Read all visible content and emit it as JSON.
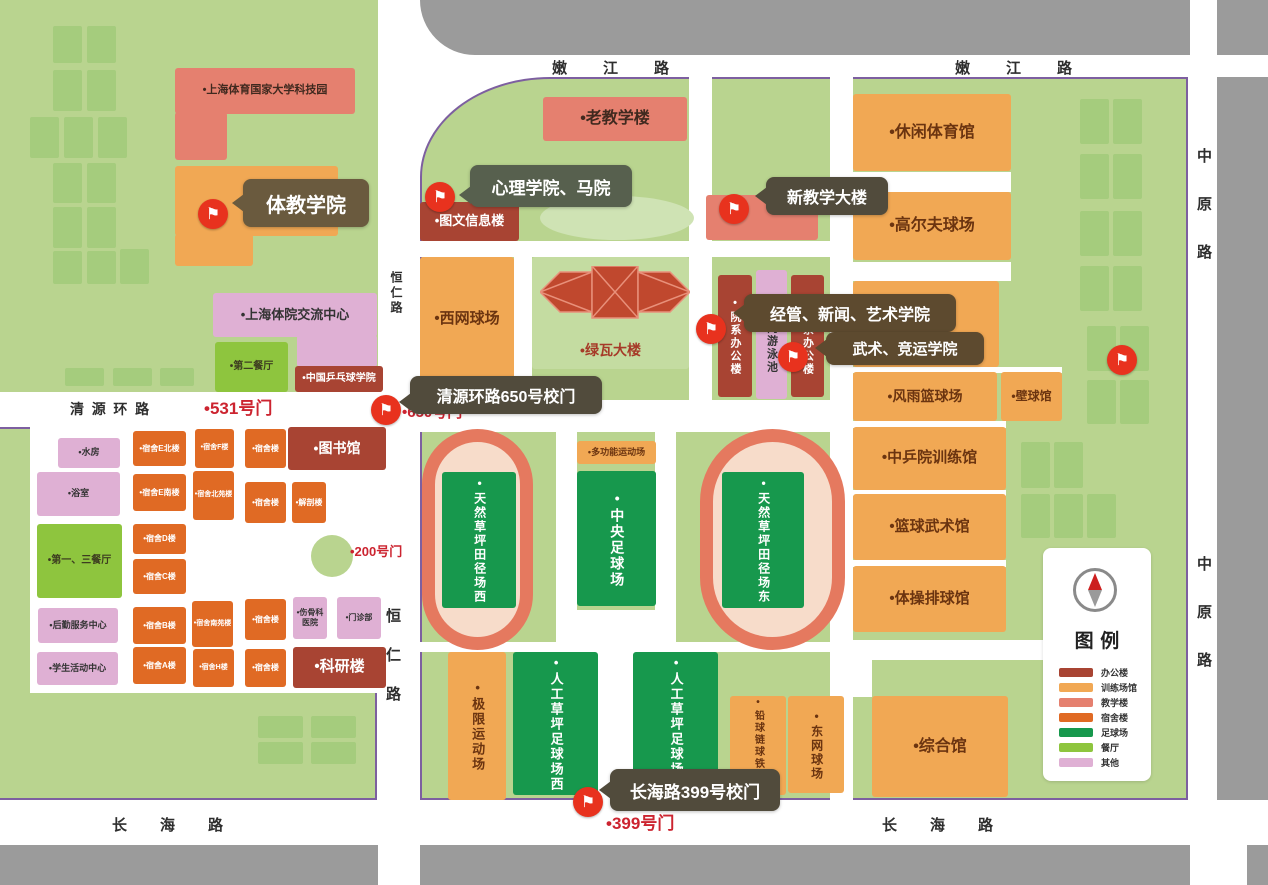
{
  "palette": {
    "bg_green": "#b9d48f",
    "tree": "#a5cc7d",
    "road_gray": "#9b9b9b",
    "boundary": "#7d5fa0",
    "track_ring": "#e5795f",
    "track_infield": "#f7dcca",
    "flag_red": "#e8321e",
    "gate_text": "#cc2430",
    "fill": {
      "office": "#a84433",
      "training": "#f1a854",
      "teaching": "#e5806f",
      "dorm": "#e06a24",
      "football": "#17984d",
      "dining": "#8ec53e",
      "other": "#dfb0d4",
      "block": "#c4dca1",
      "block2": "#cfe3b4"
    },
    "text": {
      "office": "#ffffff",
      "training": "#6b3410",
      "teaching": "#40291f",
      "dorm": "#ffffff",
      "football": "#ffffff",
      "dining": "#3d3d20",
      "other": "#4a4a4a",
      "block": "#a63a28",
      "block2": "#a63a28"
    }
  },
  "roads": {
    "labels": [
      {
        "name": "road-label-nenjiang-west",
        "text": "嫩江路",
        "x": 552,
        "y": 57,
        "fs": 15,
        "ls": "2.4em"
      },
      {
        "name": "road-label-nenjiang-east",
        "text": "嫩江路",
        "x": 955,
        "y": 57,
        "fs": 15,
        "ls": "2.4em"
      },
      {
        "name": "road-label-zhongyuan-top",
        "text": "中原路",
        "x": 1193,
        "y": 148,
        "fs": 15,
        "ls": "2.2em",
        "v": true
      },
      {
        "name": "road-label-zhongyuan-bottom",
        "text": "中原路",
        "x": 1193,
        "y": 556,
        "fs": 15,
        "ls": "2.2em",
        "v": true
      },
      {
        "name": "road-label-hengren-top",
        "text": "恒仁路",
        "x": 388,
        "y": 271,
        "fs": 12,
        "ls": "0.25em",
        "v": true
      },
      {
        "name": "road-label-hengren-bottom",
        "text": "恒仁路",
        "x": 382,
        "y": 608,
        "fs": 15,
        "ls": "1.6em",
        "v": true
      },
      {
        "name": "road-label-qingyuan",
        "text": "清源环路",
        "x": 70,
        "y": 399,
        "fs": 14,
        "ls": "0.55em"
      },
      {
        "name": "road-label-changhai-west",
        "text": "长海路",
        "x": 112,
        "y": 814,
        "fs": 15,
        "ls": "2.2em"
      },
      {
        "name": "road-label-changhai-east",
        "text": "长海路",
        "x": 882,
        "y": 814,
        "fs": 15,
        "ls": "2.2em"
      }
    ]
  },
  "gates": [
    {
      "name": "gate-label-531",
      "label": "•531号门",
      "x": 204,
      "y": 394,
      "fs": 17
    },
    {
      "name": "gate-label-650",
      "label": "•650号门",
      "x": 402,
      "y": 401,
      "fs": 15
    },
    {
      "name": "gate-label-200",
      "label": "•200号门",
      "x": 350,
      "y": 541,
      "fs": 13
    },
    {
      "name": "gate-label-399",
      "label": "•399号门",
      "x": 606,
      "y": 809,
      "fs": 17
    }
  ],
  "tooltips": [
    {
      "name": "tooltip-tijiao-xueyuan",
      "text": "体教学院",
      "x": 243,
      "y": 179,
      "w": 126,
      "h": 48,
      "fs": 20,
      "color": "#6a5a3e",
      "ptr": 24
    },
    {
      "name": "tooltip-xinli-xueyuan",
      "text": "心理学院、马院",
      "x": 470,
      "y": 165,
      "w": 162,
      "h": 42,
      "fs": 17,
      "color": "#57604e",
      "ptr": 30
    },
    {
      "name": "tooltip-xin-jiaoxue-dalou",
      "text": "新教学大楼",
      "x": 766,
      "y": 177,
      "w": 122,
      "h": 38,
      "fs": 16,
      "color": "#514b3c",
      "ptr": 19
    },
    {
      "name": "tooltip-qingyuan-gate",
      "text": "清源环路650号校门",
      "x": 410,
      "y": 376,
      "w": 192,
      "h": 38,
      "fs": 16,
      "color": "#514b3c",
      "ptr": 26
    },
    {
      "name": "tooltip-jingguan-xinwen",
      "text": "经管、新闻、艺术学院",
      "x": 744,
      "y": 294,
      "w": 212,
      "h": 38,
      "fs": 16,
      "color": "#5d4a2f",
      "ptr": 19
    },
    {
      "name": "tooltip-wushu-jingyun",
      "text": "武术、竞运学院",
      "x": 826,
      "y": 332,
      "w": 158,
      "h": 33,
      "fs": 15,
      "color": "#5d4a2f",
      "ptr": 16
    },
    {
      "name": "tooltip-changhai-gate",
      "text": "长海路399号校门",
      "x": 610,
      "y": 769,
      "w": 170,
      "h": 42,
      "fs": 17,
      "color": "#514b3c",
      "ptr": 21
    }
  ],
  "flags": [
    {
      "name": "flag-marker-tijiao",
      "x": 213,
      "y": 214
    },
    {
      "name": "flag-marker-tuwen",
      "x": 440,
      "y": 197
    },
    {
      "name": "flag-marker-xinjiaoxue",
      "x": 734,
      "y": 209
    },
    {
      "name": "flag-marker-yuanxi-a",
      "x": 711,
      "y": 329
    },
    {
      "name": "flag-marker-yuanxi-b",
      "x": 793,
      "y": 357
    },
    {
      "name": "flag-marker-gate-650",
      "x": 386,
      "y": 410
    },
    {
      "name": "flag-marker-east",
      "x": 1122,
      "y": 360
    },
    {
      "name": "flag-marker-gate-399",
      "x": 588,
      "y": 802
    }
  ],
  "buildings": [
    {
      "name": "science-park",
      "label": "•上海体育国家大学科技园",
      "x": 175,
      "y": 68,
      "w": 180,
      "h": 46,
      "t": "teaching",
      "fs": 11
    },
    {
      "name": "science-park-wing",
      "label": "",
      "x": 175,
      "y": 112,
      "w": 52,
      "h": 48,
      "t": "teaching"
    },
    {
      "name": "tijiao-college",
      "label": "",
      "x": 175,
      "y": 166,
      "w": 163,
      "h": 70,
      "t": "training"
    },
    {
      "name": "tijiao-college-wing",
      "label": "",
      "x": 175,
      "y": 234,
      "w": 78,
      "h": 32,
      "t": "training"
    },
    {
      "name": "exchange-center",
      "label": "•上海体院交流中心",
      "x": 213,
      "y": 293,
      "w": 164,
      "h": 44,
      "t": "other",
      "fs": 13,
      "tc": "#333333"
    },
    {
      "name": "exchange-center-wing",
      "label": "",
      "x": 297,
      "y": 335,
      "w": 80,
      "h": 32,
      "t": "other"
    },
    {
      "name": "no2-dining-hall",
      "label": "•第二餐厅",
      "x": 215,
      "y": 342,
      "w": 73,
      "h": 50,
      "t": "dining",
      "fs": 10
    },
    {
      "name": "table-tennis-college",
      "label": "•中国乒乓球学院",
      "x": 295,
      "y": 366,
      "w": 88,
      "h": 26,
      "t": "office",
      "fs": 10
    },
    {
      "name": "water-room",
      "label": "•水房",
      "x": 58,
      "y": 438,
      "w": 62,
      "h": 30,
      "t": "other",
      "fs": 9,
      "tc": "#333333"
    },
    {
      "name": "bath-room",
      "label": "•浴室",
      "x": 37,
      "y": 472,
      "w": 83,
      "h": 44,
      "t": "other",
      "fs": 9,
      "tc": "#333333"
    },
    {
      "name": "no13-dining-hall",
      "label": "•第一、三餐厅",
      "x": 37,
      "y": 524,
      "w": 85,
      "h": 74,
      "t": "dining",
      "fs": 10
    },
    {
      "name": "logistics-center",
      "label": "•后勤服务中心",
      "x": 38,
      "y": 608,
      "w": 80,
      "h": 35,
      "t": "other",
      "fs": 9,
      "tc": "#333333"
    },
    {
      "name": "student-center",
      "label": "•学生活动中心",
      "x": 37,
      "y": 652,
      "w": 81,
      "h": 33,
      "t": "other",
      "fs": 9,
      "tc": "#333333"
    },
    {
      "name": "dorm-e-north",
      "label": "•宿舍E北楼",
      "x": 133,
      "y": 431,
      "w": 53,
      "h": 35,
      "t": "dorm",
      "fs": 8
    },
    {
      "name": "dorm-e-south",
      "label": "•宿舍E南楼",
      "x": 133,
      "y": 474,
      "w": 53,
      "h": 37,
      "t": "dorm",
      "fs": 8
    },
    {
      "name": "dorm-d",
      "label": "•宿舍D楼",
      "x": 133,
      "y": 524,
      "w": 53,
      "h": 30,
      "t": "dorm",
      "fs": 8
    },
    {
      "name": "dorm-c",
      "label": "•宿舍C楼",
      "x": 133,
      "y": 559,
      "w": 53,
      "h": 35,
      "t": "dorm",
      "fs": 8
    },
    {
      "name": "dorm-b",
      "label": "•宿舍B楼",
      "x": 133,
      "y": 607,
      "w": 53,
      "h": 37,
      "t": "dorm",
      "fs": 8
    },
    {
      "name": "dorm-a",
      "label": "•宿舍A楼",
      "x": 133,
      "y": 647,
      "w": 53,
      "h": 37,
      "t": "dorm",
      "fs": 8
    },
    {
      "name": "dorm-f",
      "label": "•宿舍F楼",
      "x": 195,
      "y": 429,
      "w": 39,
      "h": 39,
      "t": "dorm",
      "fs": 7
    },
    {
      "name": "dorm-beiyuan",
      "label": "•宿舍北苑楼",
      "x": 193,
      "y": 471,
      "w": 41,
      "h": 49,
      "t": "dorm",
      "fs": 7
    },
    {
      "name": "dorm-nanyuan",
      "label": "•宿舍南苑楼",
      "x": 192,
      "y": 601,
      "w": 41,
      "h": 46,
      "t": "dorm",
      "fs": 7
    },
    {
      "name": "dorm-h",
      "label": "•宿舍H楼",
      "x": 193,
      "y": 649,
      "w": 41,
      "h": 38,
      "t": "dorm",
      "fs": 7
    },
    {
      "name": "dorm-1",
      "label": "•宿舍楼",
      "x": 245,
      "y": 429,
      "w": 41,
      "h": 39,
      "t": "dorm",
      "fs": 8
    },
    {
      "name": "dorm-2",
      "label": "•宿舍楼",
      "x": 245,
      "y": 482,
      "w": 41,
      "h": 41,
      "t": "dorm",
      "fs": 8
    },
    {
      "name": "dorm-3",
      "label": "•宿舍楼",
      "x": 245,
      "y": 599,
      "w": 41,
      "h": 41,
      "t": "dorm",
      "fs": 8
    },
    {
      "name": "dorm-4",
      "label": "•宿舍楼",
      "x": 245,
      "y": 649,
      "w": 41,
      "h": 38,
      "t": "dorm",
      "fs": 8
    },
    {
      "name": "anatomy-building",
      "label": "•解剖楼",
      "x": 292,
      "y": 482,
      "w": 34,
      "h": 41,
      "t": "dorm",
      "fs": 8
    },
    {
      "name": "library",
      "label": "•图书馆",
      "x": 288,
      "y": 427,
      "w": 98,
      "h": 43,
      "t": "office",
      "fs": 14
    },
    {
      "name": "osteopathy-hospital",
      "label": "•伤骨科医院",
      "x": 293,
      "y": 597,
      "w": 34,
      "h": 42,
      "t": "other",
      "fs": 8,
      "tc": "#333333"
    },
    {
      "name": "clinic",
      "label": "•门诊部",
      "x": 337,
      "y": 597,
      "w": 44,
      "h": 42,
      "t": "other",
      "fs": 8,
      "tc": "#333333"
    },
    {
      "name": "research-building",
      "label": "•科研楼",
      "x": 293,
      "y": 647,
      "w": 93,
      "h": 41,
      "t": "office",
      "fs": 15
    },
    {
      "name": "old-teaching-building",
      "label": "•老教学楼",
      "x": 543,
      "y": 97,
      "w": 144,
      "h": 44,
      "t": "teaching",
      "fs": 16
    },
    {
      "name": "library-info-building",
      "label": "•图文信息楼",
      "x": 420,
      "y": 202,
      "w": 99,
      "h": 39,
      "t": "office",
      "fs": 13
    },
    {
      "name": "new-teaching-building",
      "label": "",
      "x": 706,
      "y": 195,
      "w": 112,
      "h": 45,
      "t": "teaching"
    },
    {
      "name": "west-tennis-court",
      "label": "•西网球场",
      "x": 420,
      "y": 257,
      "w": 94,
      "h": 124,
      "t": "training",
      "fs": 15
    },
    {
      "name": "lvwa-building",
      "label": "•绿瓦大楼",
      "x": 532,
      "y": 257,
      "w": 157,
      "h": 112,
      "t": "block",
      "fs": 14,
      "la": "bottom"
    },
    {
      "name": "grass-oval",
      "label": "",
      "x": 540,
      "y": 196,
      "w": 154,
      "h": 44,
      "t": "block2",
      "round": true
    },
    {
      "name": "dept-office-a",
      "label": "•院系办公楼",
      "x": 718,
      "y": 275,
      "w": 34,
      "h": 122,
      "t": "office",
      "fs": 11,
      "v": true
    },
    {
      "name": "indoor-pool",
      "label": "•室内游泳池",
      "x": 756,
      "y": 270,
      "w": 31,
      "h": 129,
      "t": "other",
      "fs": 11,
      "v": true,
      "tc": "#333333"
    },
    {
      "name": "dept-office-b",
      "label": "•院系办公楼",
      "x": 791,
      "y": 275,
      "w": 33,
      "h": 122,
      "t": "office",
      "fs": 11,
      "v": true
    },
    {
      "name": "track-field-hall",
      "label": "•田径馆",
      "x": 853,
      "y": 281,
      "w": 146,
      "h": 86,
      "t": "training",
      "fs": 15
    },
    {
      "name": "leisure-sports-gym",
      "label": "•休闲体育馆",
      "x": 853,
      "y": 94,
      "w": 158,
      "h": 77,
      "t": "training",
      "fs": 16
    },
    {
      "name": "golf-course",
      "label": "•高尔夫球场",
      "x": 853,
      "y": 192,
      "w": 158,
      "h": 68,
      "t": "training",
      "fs": 16
    },
    {
      "name": "storm-basketball-court",
      "label": "•风雨篮球场",
      "x": 853,
      "y": 372,
      "w": 144,
      "h": 49,
      "t": "training",
      "fs": 14
    },
    {
      "name": "squash-hall",
      "label": "•壁球馆",
      "x": 1001,
      "y": 372,
      "w": 61,
      "h": 49,
      "t": "training",
      "fs": 12
    },
    {
      "name": "ctt-training-hall",
      "label": "•中乒院训练馆",
      "x": 853,
      "y": 427,
      "w": 153,
      "h": 63,
      "t": "training",
      "fs": 15
    },
    {
      "name": "basketball-wushu-hall",
      "label": "•篮球武术馆",
      "x": 853,
      "y": 494,
      "w": 153,
      "h": 66,
      "t": "training",
      "fs": 15
    },
    {
      "name": "gymnastics-volleyball-hall",
      "label": "•体操排球馆",
      "x": 853,
      "y": 566,
      "w": 153,
      "h": 66,
      "t": "training",
      "fs": 15
    },
    {
      "name": "comprehensive-hall",
      "label": "•综合馆",
      "x": 872,
      "y": 696,
      "w": 136,
      "h": 101,
      "t": "training",
      "fs": 16
    },
    {
      "name": "multifunction-field",
      "label": "•多功能运动场",
      "x": 577,
      "y": 441,
      "w": 79,
      "h": 23,
      "t": "training",
      "fs": 9
    },
    {
      "name": "natural-turf-west",
      "label": "•天然草坪田径场西",
      "x": 442,
      "y": 472,
      "w": 74,
      "h": 136,
      "t": "football",
      "fs": 12,
      "v": true
    },
    {
      "name": "central-football-field",
      "label": "•中央足球场",
      "x": 577,
      "y": 471,
      "w": 79,
      "h": 135,
      "t": "football",
      "fs": 14,
      "v": true
    },
    {
      "name": "natural-turf-east",
      "label": "•天然草坪田径场东",
      "x": 722,
      "y": 472,
      "w": 82,
      "h": 136,
      "t": "football",
      "fs": 12,
      "v": true
    },
    {
      "name": "extreme-sports-field",
      "label": "•极限运动场",
      "x": 448,
      "y": 652,
      "w": 58,
      "h": 148,
      "t": "training",
      "fs": 13,
      "v": true
    },
    {
      "name": "artificial-turf-west",
      "label": "•人工草坪足球场西",
      "x": 513,
      "y": 652,
      "w": 85,
      "h": 143,
      "t": "football",
      "fs": 13,
      "v": true
    },
    {
      "name": "artificial-turf-east",
      "label": "•人工草坪足球场东",
      "x": 633,
      "y": 652,
      "w": 85,
      "h": 143,
      "t": "football",
      "fs": 13,
      "v": true
    },
    {
      "name": "shot-put-field",
      "label": "•铅球链球铁饼场",
      "x": 730,
      "y": 696,
      "w": 56,
      "h": 99,
      "t": "training",
      "fs": 10,
      "v": true
    },
    {
      "name": "east-tennis-court",
      "label": "•东网球场",
      "x": 788,
      "y": 696,
      "w": 56,
      "h": 97,
      "t": "training",
      "fs": 12,
      "v": true
    }
  ],
  "trees": [
    [
      53,
      26,
      29,
      37
    ],
    [
      87,
      26,
      29,
      37
    ],
    [
      53,
      70,
      29,
      41
    ],
    [
      87,
      70,
      29,
      41
    ],
    [
      30,
      117,
      29,
      41
    ],
    [
      64,
      117,
      29,
      41
    ],
    [
      98,
      117,
      29,
      41
    ],
    [
      53,
      163,
      29,
      40
    ],
    [
      87,
      163,
      29,
      40
    ],
    [
      53,
      207,
      29,
      41
    ],
    [
      87,
      207,
      29,
      41
    ],
    [
      53,
      251,
      29,
      33
    ],
    [
      87,
      251,
      29,
      33
    ],
    [
      120,
      249,
      29,
      35
    ],
    [
      65,
      368,
      39,
      18
    ],
    [
      113,
      368,
      39,
      18
    ],
    [
      160,
      368,
      34,
      18
    ],
    [
      258,
      716,
      45,
      22
    ],
    [
      311,
      716,
      45,
      22
    ],
    [
      258,
      742,
      45,
      22
    ],
    [
      311,
      742,
      45,
      22
    ],
    [
      1080,
      99,
      29,
      45
    ],
    [
      1113,
      99,
      29,
      45
    ],
    [
      1080,
      154,
      29,
      45
    ],
    [
      1113,
      154,
      29,
      45
    ],
    [
      1080,
      211,
      29,
      45
    ],
    [
      1113,
      211,
      29,
      45
    ],
    [
      1080,
      266,
      29,
      45
    ],
    [
      1113,
      266,
      29,
      45
    ],
    [
      1087,
      326,
      29,
      45
    ],
    [
      1120,
      326,
      29,
      45
    ],
    [
      1087,
      380,
      29,
      44
    ],
    [
      1120,
      380,
      29,
      44
    ],
    [
      1021,
      442,
      29,
      46
    ],
    [
      1054,
      442,
      29,
      46
    ],
    [
      1021,
      494,
      29,
      44
    ],
    [
      1054,
      494,
      29,
      44
    ],
    [
      1087,
      494,
      29,
      44
    ]
  ],
  "legend": {
    "title": "图例",
    "items": [
      {
        "label": "办公楼",
        "color": "#a84433"
      },
      {
        "label": "训练场馆",
        "color": "#f1a854"
      },
      {
        "label": "教学楼",
        "color": "#e5806f"
      },
      {
        "label": "宿舍楼",
        "color": "#e06a24"
      },
      {
        "label": "足球场",
        "color": "#17984d"
      },
      {
        "label": "餐厅",
        "color": "#8ec53e"
      },
      {
        "label": "其他",
        "color": "#dfb0d4"
      }
    ]
  }
}
